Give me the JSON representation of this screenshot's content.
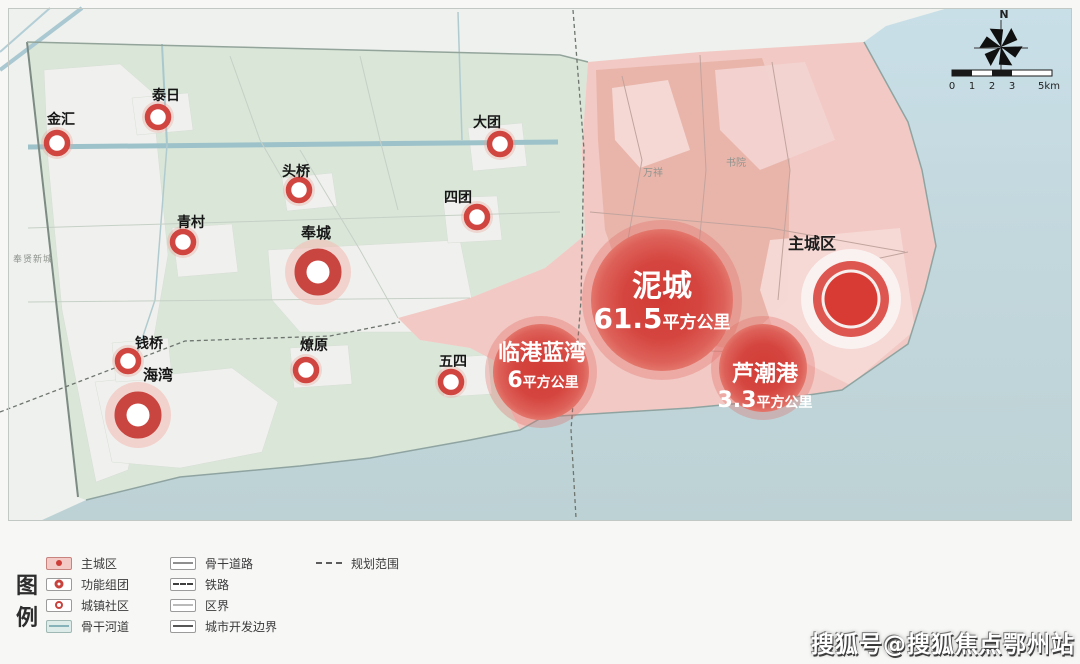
{
  "map": {
    "compass_label": "N",
    "scale_ticks": [
      "0",
      "1",
      "2",
      "3",
      "5km"
    ],
    "districts": [
      {
        "name": "泥城",
        "area": "61.5",
        "unit": "平方公里"
      },
      {
        "name": "临港蓝湾",
        "area": "6",
        "unit": "平方公里"
      },
      {
        "name": "芦潮港",
        "area": "3.3",
        "unit": "平方公里"
      }
    ],
    "main_city_label": "主城区",
    "clusters": [
      {
        "name": "奉城"
      },
      {
        "name": "海湾"
      }
    ],
    "towns": [
      {
        "name": "金汇"
      },
      {
        "name": "泰日"
      },
      {
        "name": "头桥"
      },
      {
        "name": "青村"
      },
      {
        "name": "大团"
      },
      {
        "name": "四团"
      },
      {
        "name": "钱桥"
      },
      {
        "name": "燎原"
      },
      {
        "name": "五四"
      }
    ],
    "faint_labels": [
      {
        "name": "万祥"
      },
      {
        "name": "书院"
      },
      {
        "name": "奉贤新城"
      }
    ]
  },
  "legend": {
    "title_chars": [
      "图",
      "例"
    ],
    "col1": [
      {
        "label": "主城区"
      },
      {
        "label": "功能组团"
      },
      {
        "label": "城镇社区"
      },
      {
        "label": "骨干河道"
      }
    ],
    "col2": [
      {
        "label": "骨干道路"
      },
      {
        "label": "铁路"
      },
      {
        "label": "区界"
      },
      {
        "label": "城市开发边界"
      }
    ],
    "col3": [
      {
        "label": "规划范围"
      }
    ]
  },
  "watermark": "搜狐号@搜狐焦点鄂州站",
  "colors": {
    "accent_red": "#d0423c",
    "pink_region": "#f2c9c4",
    "green_region": "#d9e6d8",
    "sea": "#c3d8dc",
    "water_line": "#9dc2c9"
  }
}
